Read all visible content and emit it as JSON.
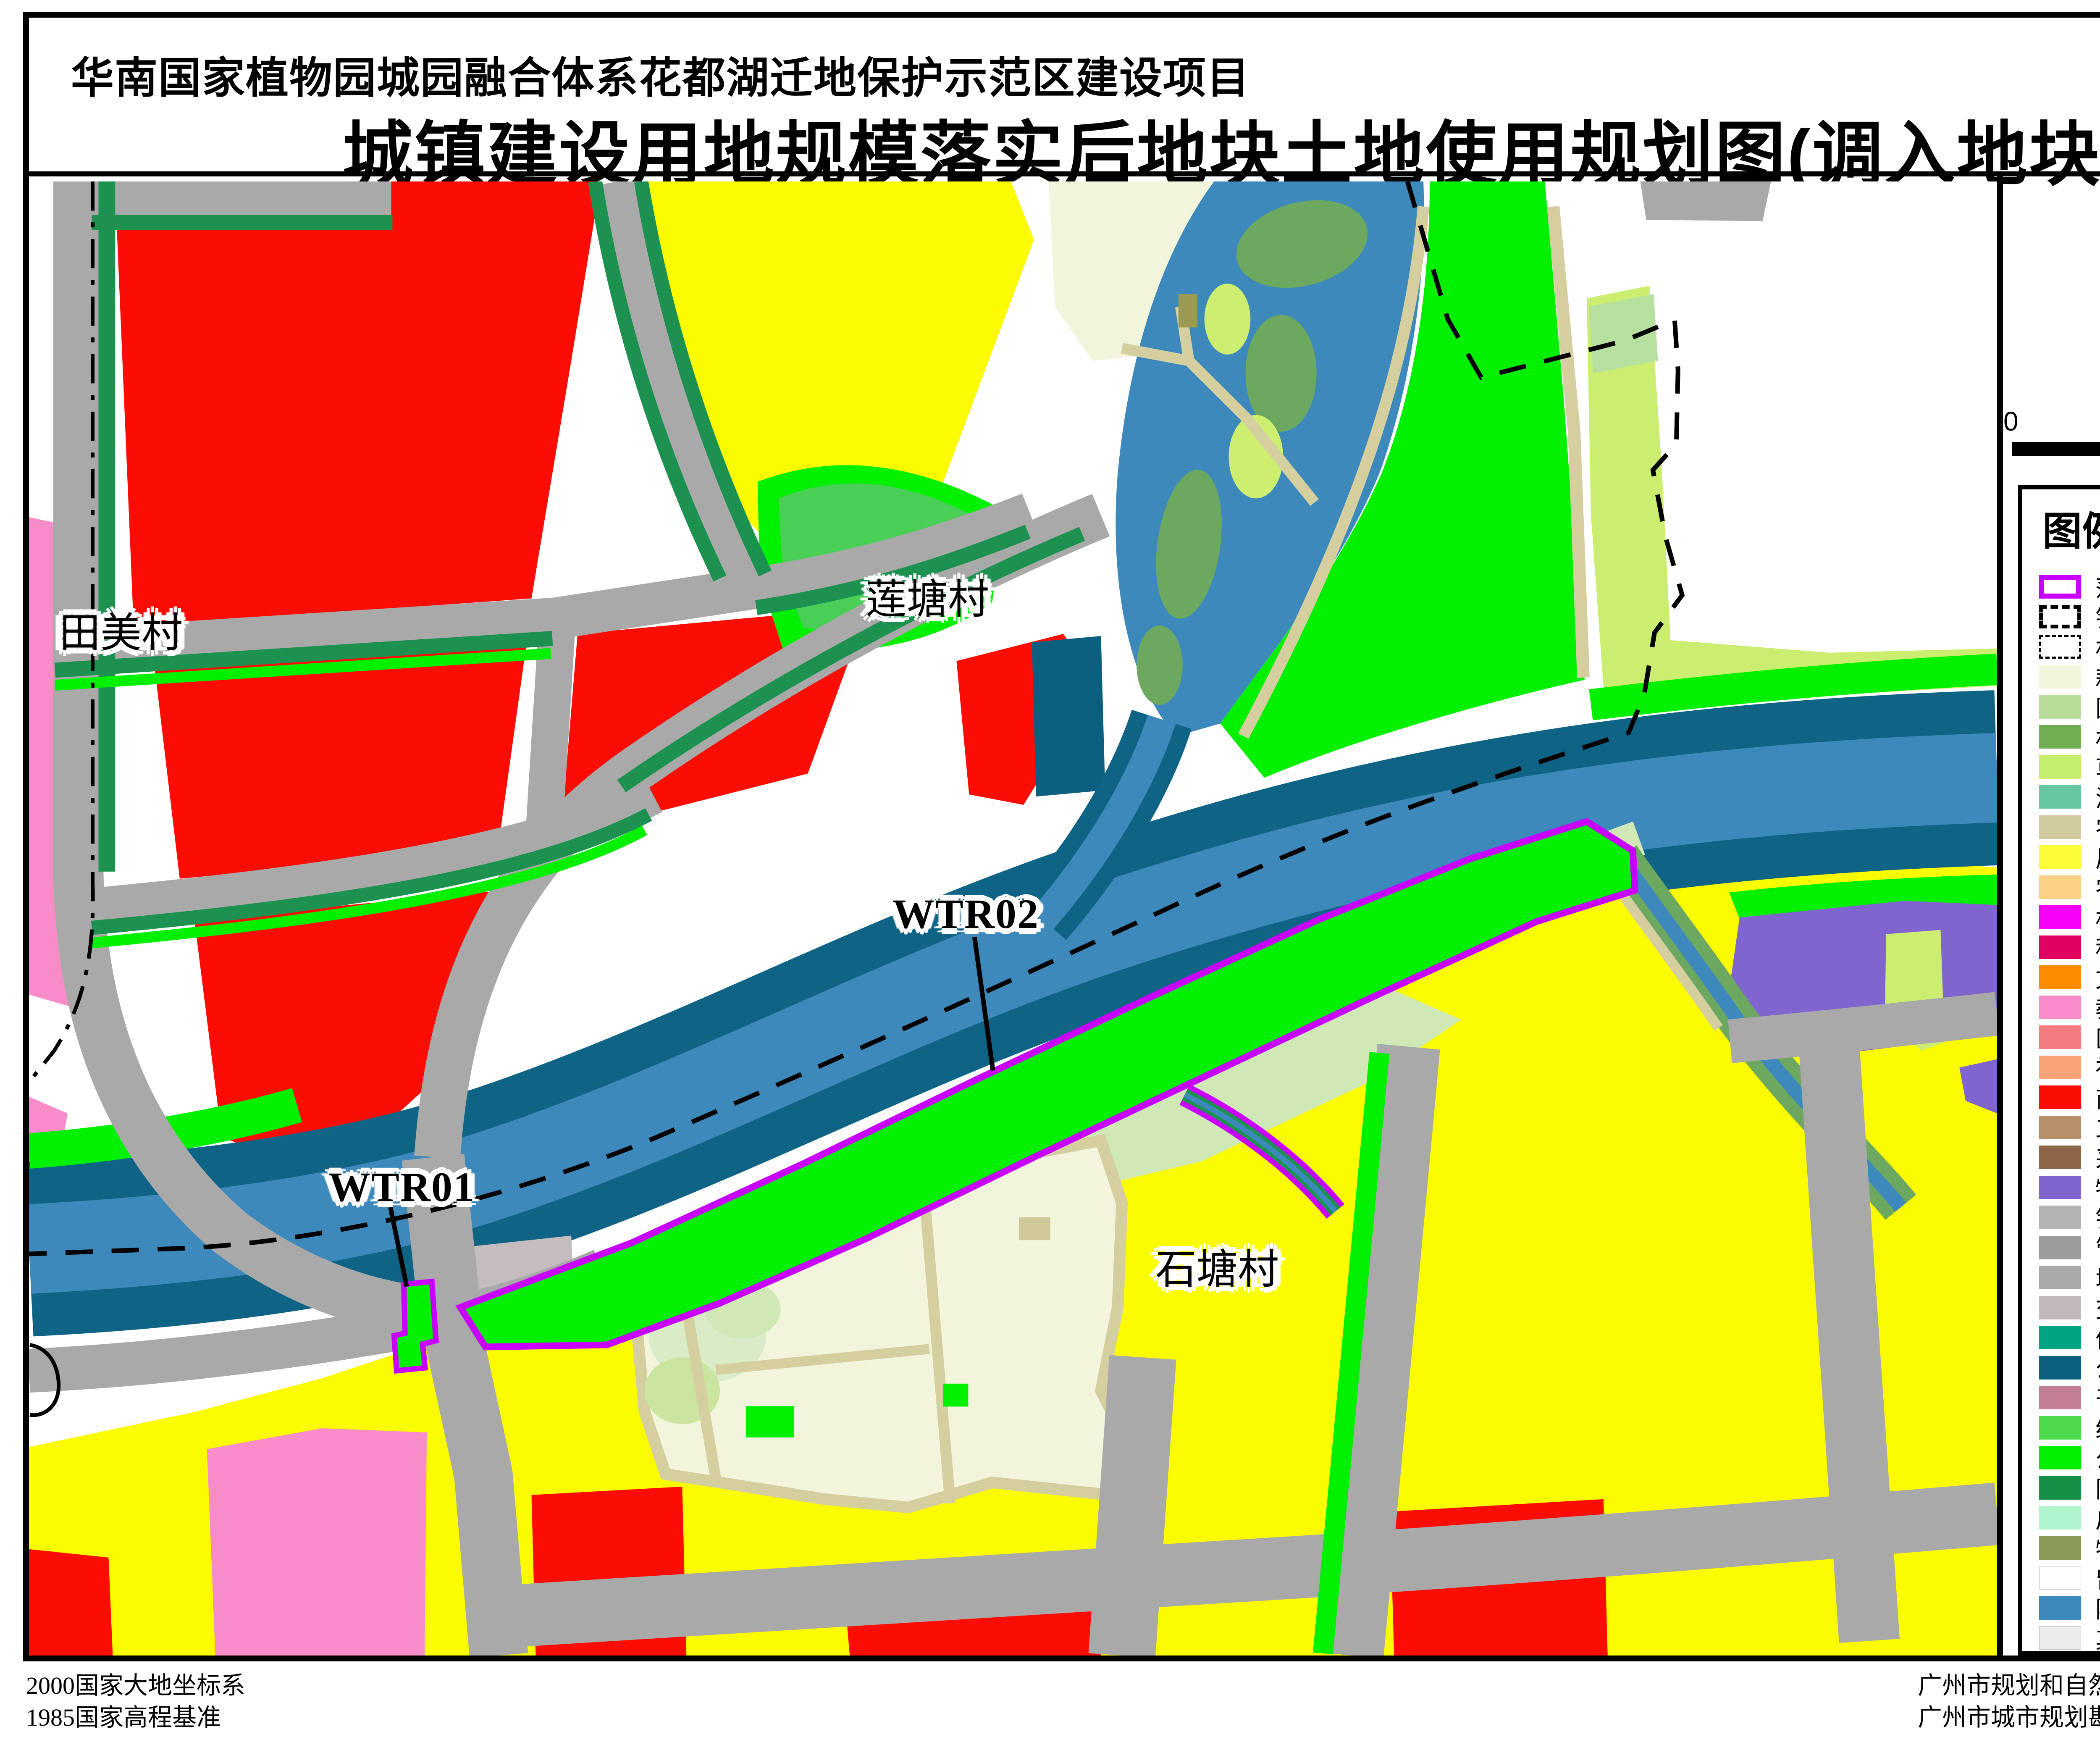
{
  "header": {
    "project_line": "华南国家植物园城园融合体系花都湖迁地保护示范区建设项目",
    "title": "城镇建设用地规模落实后地块土地使用规划图(调入地块)"
  },
  "compass": {
    "label": "N"
  },
  "scale_bar": {
    "ticks": [
      "0",
      "145",
      "290米"
    ]
  },
  "map": {
    "labels": [
      {
        "text": "田美村"
      },
      {
        "text": "莲塘村"
      },
      {
        "text": "石塘村"
      },
      {
        "text": "WTR01"
      },
      {
        "text": "WTR02"
      }
    ],
    "palette": {
      "water": "#3d89bb",
      "water_edge": "#0f6384",
      "park_green": "#00f000",
      "protect_green": "#1d9150",
      "residential_yellow": "#fcfc00",
      "commercial_red": "#fb0d05",
      "education_pink": "#f78cc8",
      "logistics_purple": "#8165cf",
      "road_gray": "#a9a9a9",
      "parcel_outline_magenta": "#c800ff",
      "farmland_cream": "#f2f5dc",
      "orchard_green": "#cfe8b6",
      "grass_yellowgreen": "#cbee70"
    }
  },
  "legend": {
    "title": "图例",
    "items": [
      {
        "label": "落实地块",
        "type": "outline",
        "color": "#c800ff"
      },
      {
        "label": "镇界",
        "type": "dash-bold",
        "color": "#000000"
      },
      {
        "label": "村界",
        "type": "dash-thin",
        "color": "#000000"
      },
      {
        "label": "耕地",
        "type": "fill",
        "color": "#f4f6dc"
      },
      {
        "label": "园地",
        "type": "fill",
        "color": "#b8dd9a"
      },
      {
        "label": "林地",
        "type": "fill",
        "color": "#6fae51"
      },
      {
        "label": "草地",
        "type": "fill",
        "color": "#c6ee6e"
      },
      {
        "label": "湿地",
        "type": "fill",
        "color": "#66c7a1"
      },
      {
        "label": "农业设施建设用地",
        "type": "fill",
        "color": "#cfcb9c"
      },
      {
        "label": "居住用地",
        "type": "fill",
        "color": "#fcfc3a"
      },
      {
        "label": "农村宅基地",
        "type": "fill",
        "color": "#fbd285"
      },
      {
        "label": "机关团体用地",
        "type": "fill",
        "color": "#f700f7"
      },
      {
        "label": "科研用地",
        "type": "fill",
        "color": "#e0005f"
      },
      {
        "label": "文化用地",
        "type": "fill",
        "color": "#fb8c00"
      },
      {
        "label": "教育用地",
        "type": "fill",
        "color": "#f78cc8"
      },
      {
        "label": "医疗卫生用地",
        "type": "fill",
        "color": "#f47c80"
      },
      {
        "label": "社会福利用地",
        "type": "fill",
        "color": "#f9a379"
      },
      {
        "label": "商业服务业用地",
        "type": "fill",
        "color": "#fb0d05"
      },
      {
        "label": "工业用地",
        "type": "fill",
        "color": "#b5906b"
      },
      {
        "label": "采矿用地",
        "type": "fill",
        "color": "#8d6748"
      },
      {
        "label": "物流仓储用地",
        "type": "fill",
        "color": "#8165cf"
      },
      {
        "label": "铁路、公路、机场、港口码头用地",
        "type": "fill",
        "color": "#b3b3b3"
      },
      {
        "label": "管道运输用地",
        "type": "fill",
        "color": "#9c9c9c"
      },
      {
        "label": "城镇道路用地",
        "type": "fill",
        "color": "#a9a9a9"
      },
      {
        "label": "交通场站及其他交通用地",
        "type": "fill",
        "color": "#c0b8bc"
      },
      {
        "label": "体育用地",
        "type": "fill",
        "color": "#00a483"
      },
      {
        "label": "公用设施用地",
        "type": "fill",
        "color": "#0d5f80"
      },
      {
        "label": "干渠",
        "type": "fill",
        "color": "#c27f93"
      },
      {
        "label": "绿地与开敞空间用地",
        "type": "fill",
        "color": "#4cd94c"
      },
      {
        "label": "公园绿地",
        "type": "fill",
        "color": "#00f000"
      },
      {
        "label": "防护绿地",
        "type": "fill",
        "color": "#168f47"
      },
      {
        "label": "广场用地",
        "type": "fill",
        "color": "#aef5cd"
      },
      {
        "label": "特殊用地",
        "type": "fill",
        "color": "#8b9a59"
      },
      {
        "label": "留白用地",
        "type": "fill",
        "color": "#ffffff"
      },
      {
        "label": "陆地水域",
        "type": "fill",
        "color": "#3d89bb"
      },
      {
        "label": "其他土地",
        "type": "fill",
        "color": "#ececec"
      }
    ]
  },
  "footer": {
    "left_lines": [
      "2000国家大地坐标系",
      "1985国家高程基准"
    ],
    "right_lines": [
      "广州市规划和自然资源局花都区分局",
      "广州市城市规划勘测设计研究院花都分院　　　　制图"
    ]
  }
}
